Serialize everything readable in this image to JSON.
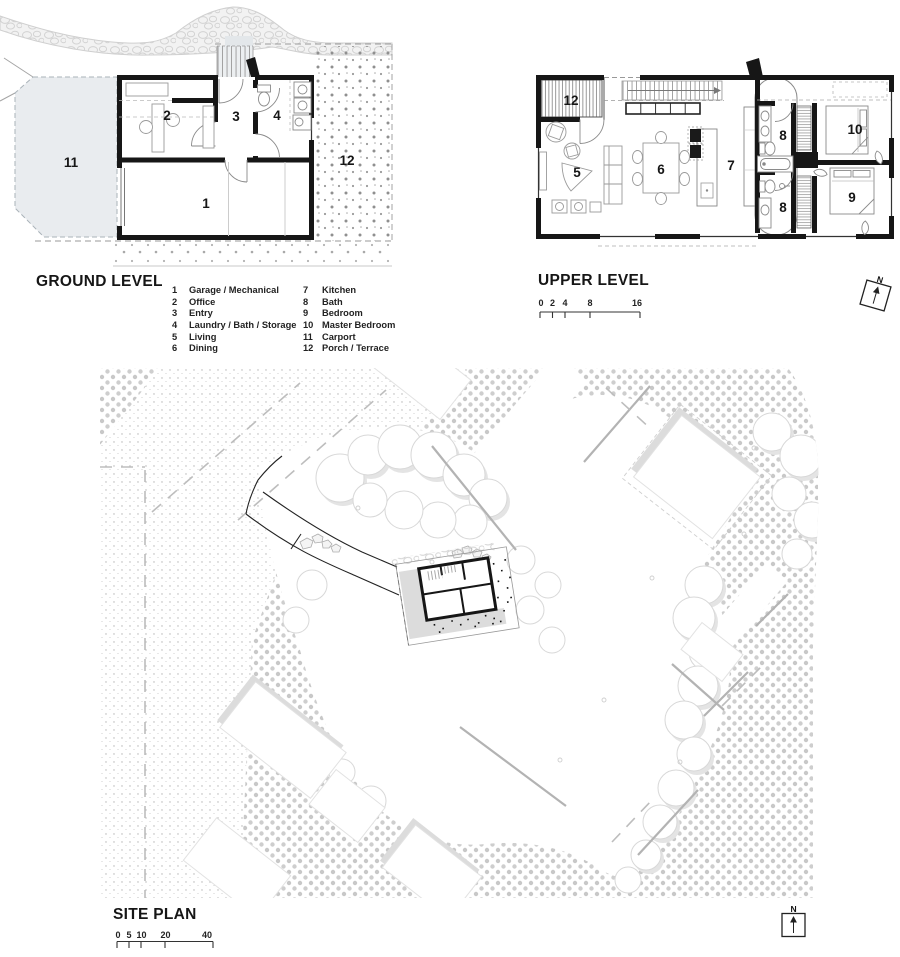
{
  "titles": {
    "ground": "GROUND LEVEL",
    "upper": "UPPER LEVEL",
    "site": "SITE PLAN"
  },
  "legend": {
    "items": [
      {
        "num": "1",
        "label": "Garage / Mechanical"
      },
      {
        "num": "2",
        "label": "Office"
      },
      {
        "num": "3",
        "label": "Entry"
      },
      {
        "num": "4",
        "label": "Laundry / Bath / Storage"
      },
      {
        "num": "5",
        "label": "Living"
      },
      {
        "num": "6",
        "label": "Dining"
      },
      {
        "num": "7",
        "label": "Kitchen"
      },
      {
        "num": "8",
        "label": "Bath"
      },
      {
        "num": "9",
        "label": "Bedroom"
      },
      {
        "num": "10",
        "label": "Master Bedroom"
      },
      {
        "num": "11",
        "label": "Carport"
      },
      {
        "num": "12",
        "label": "Porch / Terrace"
      }
    ]
  },
  "ground_plan": {
    "room_labels": {
      "garage": "1",
      "office": "2",
      "entry": "3",
      "laundry": "4",
      "carport": "11",
      "terrace": "12"
    }
  },
  "upper_plan": {
    "room_labels": {
      "porch": "12",
      "living": "5",
      "dining": "6",
      "kitchen": "7",
      "bath_upper": "8",
      "bath_lower": "8",
      "master": "10",
      "bedroom": "9"
    }
  },
  "scales": {
    "upper": {
      "ticks": [
        "0",
        "2",
        "4",
        "8",
        "16"
      ]
    },
    "site": {
      "ticks": [
        "0",
        "5",
        "10",
        "20",
        "40"
      ]
    }
  },
  "north_label": "N",
  "colors": {
    "wall": "#161616",
    "stipple": "#c8c8c8",
    "fine_stipple": "#b3b3b3",
    "carport_fill": "#e9ecef",
    "tree_edge": "#d8d8d8",
    "shadow": "#dcdcdc"
  }
}
